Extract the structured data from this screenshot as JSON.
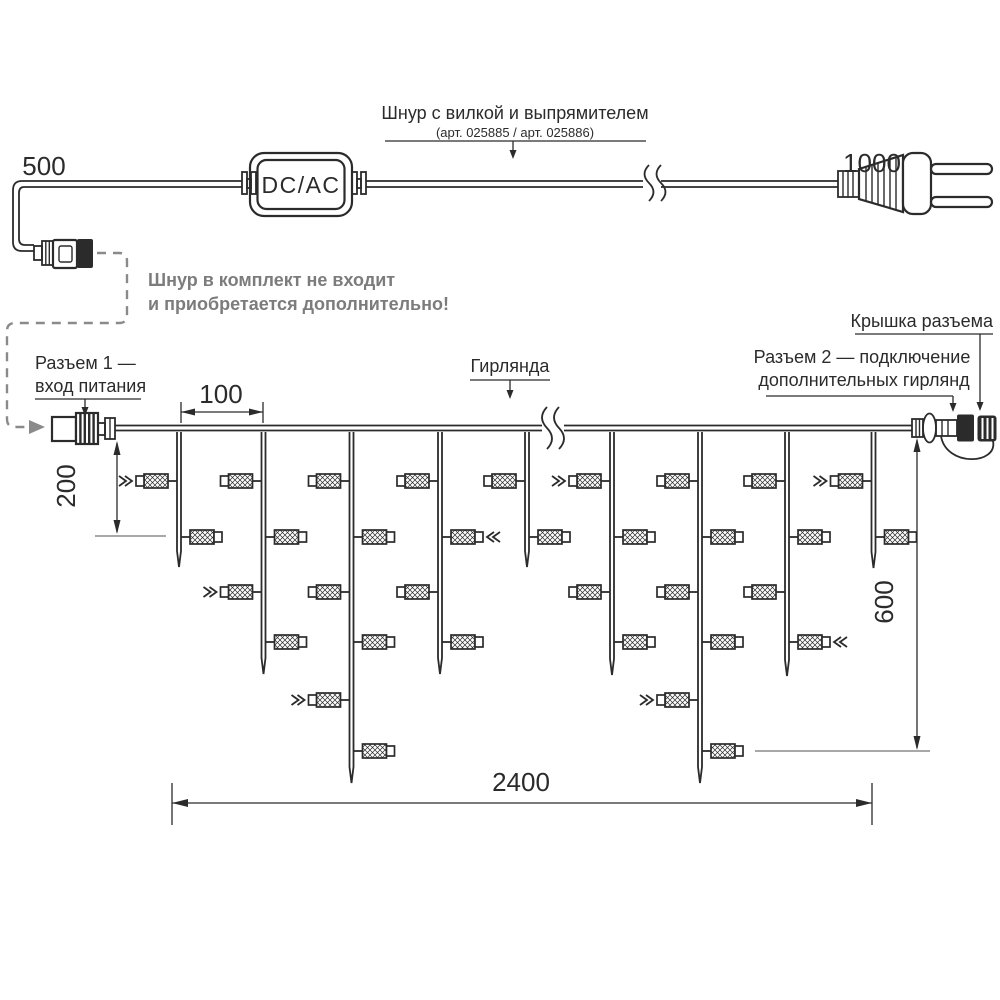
{
  "labels": {
    "cord_title": "Шнур с вилкой и выпрямителем",
    "cord_subtitle": "(арт. 025885 /  арт. 025886)",
    "converter": "DC/AC",
    "cord_note_line1": "Шнур в комплект не входит",
    "cord_note_line2": "и приобретается дополнительно!",
    "connector1_line1": "Разъем 1 —",
    "connector1_line2": "вход питания",
    "garland": "Гирлянда",
    "connector2_line1": "Разъем 2 — подключение",
    "connector2_line2": "дополнительных гирлянд",
    "cap": "Крышка разъема"
  },
  "dimensions": {
    "cord_left": "500",
    "cord_right": "1000",
    "drop_spacing": "100",
    "first_level_depth": "200",
    "max_drop_depth": "600",
    "total_length": "2400"
  },
  "colors": {
    "ink": "#2b2b2b",
    "note_gray": "#7c7c7c",
    "dashed_gray": "#8a8a8a",
    "tick_gray": "#a8a8a8"
  },
  "garland_diagram": {
    "wire": {
      "y_top": 425.5,
      "y_bottom": 430.5,
      "x_start": 115,
      "x_end": 912
    },
    "lamp_levels_y": [
      481,
      537,
      592,
      642,
      700,
      751
    ],
    "drops": [
      {
        "x": 179,
        "tip_y": 567,
        "lamps": [
          {
            "level": 1,
            "side": "left",
            "marker": true
          },
          {
            "level": 2,
            "side": "right",
            "marker": false
          }
        ]
      },
      {
        "x": 263.5,
        "tip_y": 674,
        "lamps": [
          {
            "level": 1,
            "side": "left",
            "marker": false
          },
          {
            "level": 2,
            "side": "right",
            "marker": false
          },
          {
            "level": 3,
            "side": "left",
            "marker": true
          },
          {
            "level": 4,
            "side": "right",
            "marker": false
          }
        ]
      },
      {
        "x": 351.5,
        "tip_y": 783,
        "lamps": [
          {
            "level": 1,
            "side": "left",
            "marker": false
          },
          {
            "level": 2,
            "side": "right",
            "marker": false
          },
          {
            "level": 3,
            "side": "left",
            "marker": false
          },
          {
            "level": 4,
            "side": "right",
            "marker": false
          },
          {
            "level": 5,
            "side": "left",
            "marker": true
          },
          {
            "level": 6,
            "side": "right",
            "marker": false
          }
        ]
      },
      {
        "x": 440,
        "tip_y": 674,
        "lamps": [
          {
            "level": 1,
            "side": "left",
            "marker": false
          },
          {
            "level": 2,
            "side": "right",
            "marker": true
          },
          {
            "level": 3,
            "side": "left",
            "marker": false
          },
          {
            "level": 4,
            "side": "right",
            "marker": false
          }
        ]
      },
      {
        "x": 527,
        "tip_y": 567,
        "lamps": [
          {
            "level": 1,
            "side": "left",
            "marker": false
          },
          {
            "level": 2,
            "side": "right",
            "marker": false
          }
        ]
      },
      {
        "x": 612,
        "tip_y": 675,
        "lamps": [
          {
            "level": 1,
            "side": "left",
            "marker": true
          },
          {
            "level": 2,
            "side": "right",
            "marker": false
          },
          {
            "level": 3,
            "side": "left",
            "marker": false
          },
          {
            "level": 4,
            "side": "right",
            "marker": false
          }
        ]
      },
      {
        "x": 700,
        "tip_y": 783,
        "lamps": [
          {
            "level": 1,
            "side": "left",
            "marker": false
          },
          {
            "level": 2,
            "side": "right",
            "marker": false
          },
          {
            "level": 3,
            "side": "left",
            "marker": false
          },
          {
            "level": 4,
            "side": "right",
            "marker": false
          },
          {
            "level": 5,
            "side": "left",
            "marker": true
          },
          {
            "level": 6,
            "side": "right",
            "marker": false
          }
        ]
      },
      {
        "x": 787,
        "tip_y": 676,
        "lamps": [
          {
            "level": 1,
            "side": "left",
            "marker": false
          },
          {
            "level": 2,
            "side": "right",
            "marker": false
          },
          {
            "level": 3,
            "side": "left",
            "marker": false
          },
          {
            "level": 4,
            "side": "right",
            "marker": true
          }
        ]
      },
      {
        "x": 873.5,
        "tip_y": 568,
        "lamps": [
          {
            "level": 1,
            "side": "left",
            "marker": true
          },
          {
            "level": 2,
            "side": "right",
            "marker": false
          }
        ]
      }
    ]
  }
}
